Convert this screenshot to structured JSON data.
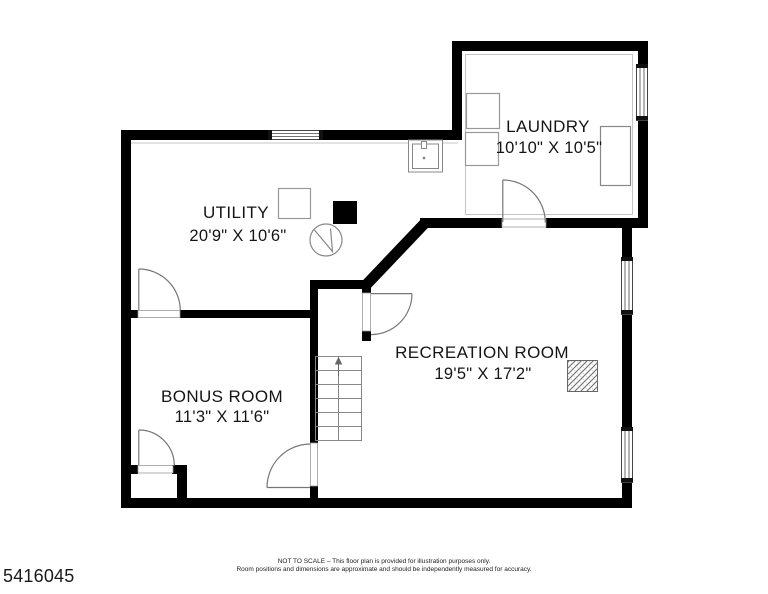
{
  "rooms": {
    "laundry": {
      "name": "LAUNDRY",
      "dims": "10'10\" X 10'5\""
    },
    "utility": {
      "name": "UTILITY",
      "dims": "20'9\" X 10'6\""
    },
    "recreation": {
      "name": "RECREATION ROOM",
      "dims": "19'5\" X 17'2\""
    },
    "bonus": {
      "name": "BONUS ROOM",
      "dims": "11'3\" X 11'6\""
    }
  },
  "footer": {
    "plan_id": "5416045",
    "disclaimer_line1": "NOT TO SCALE – This floor plan is provided for illustration purposes only.",
    "disclaimer_line2": "Room positions and dimensions are approximate and should be independently measured for accuracy."
  },
  "icons": {
    "door-swing-icon": "quarter-circle arc with open leaf",
    "window-icon": "double-line opening in wall",
    "stairs-icon": "tread lines with center rail and up arrow",
    "laundry-sink-icon": "double rectangle with faucet",
    "washer-icon": "outlined square",
    "dryer-icon": "outlined square",
    "laundry-tub-icon": "outlined tall rectangle",
    "equipment-square-icon": "outlined square",
    "support-post-icon": "solid black square",
    "sump-pump-icon": "circle with zigzag",
    "column-hatch-icon": "diagonal-hatched square"
  },
  "colors": {
    "wall": "#000000",
    "fixture_line": "#888888",
    "background": "#ffffff"
  }
}
